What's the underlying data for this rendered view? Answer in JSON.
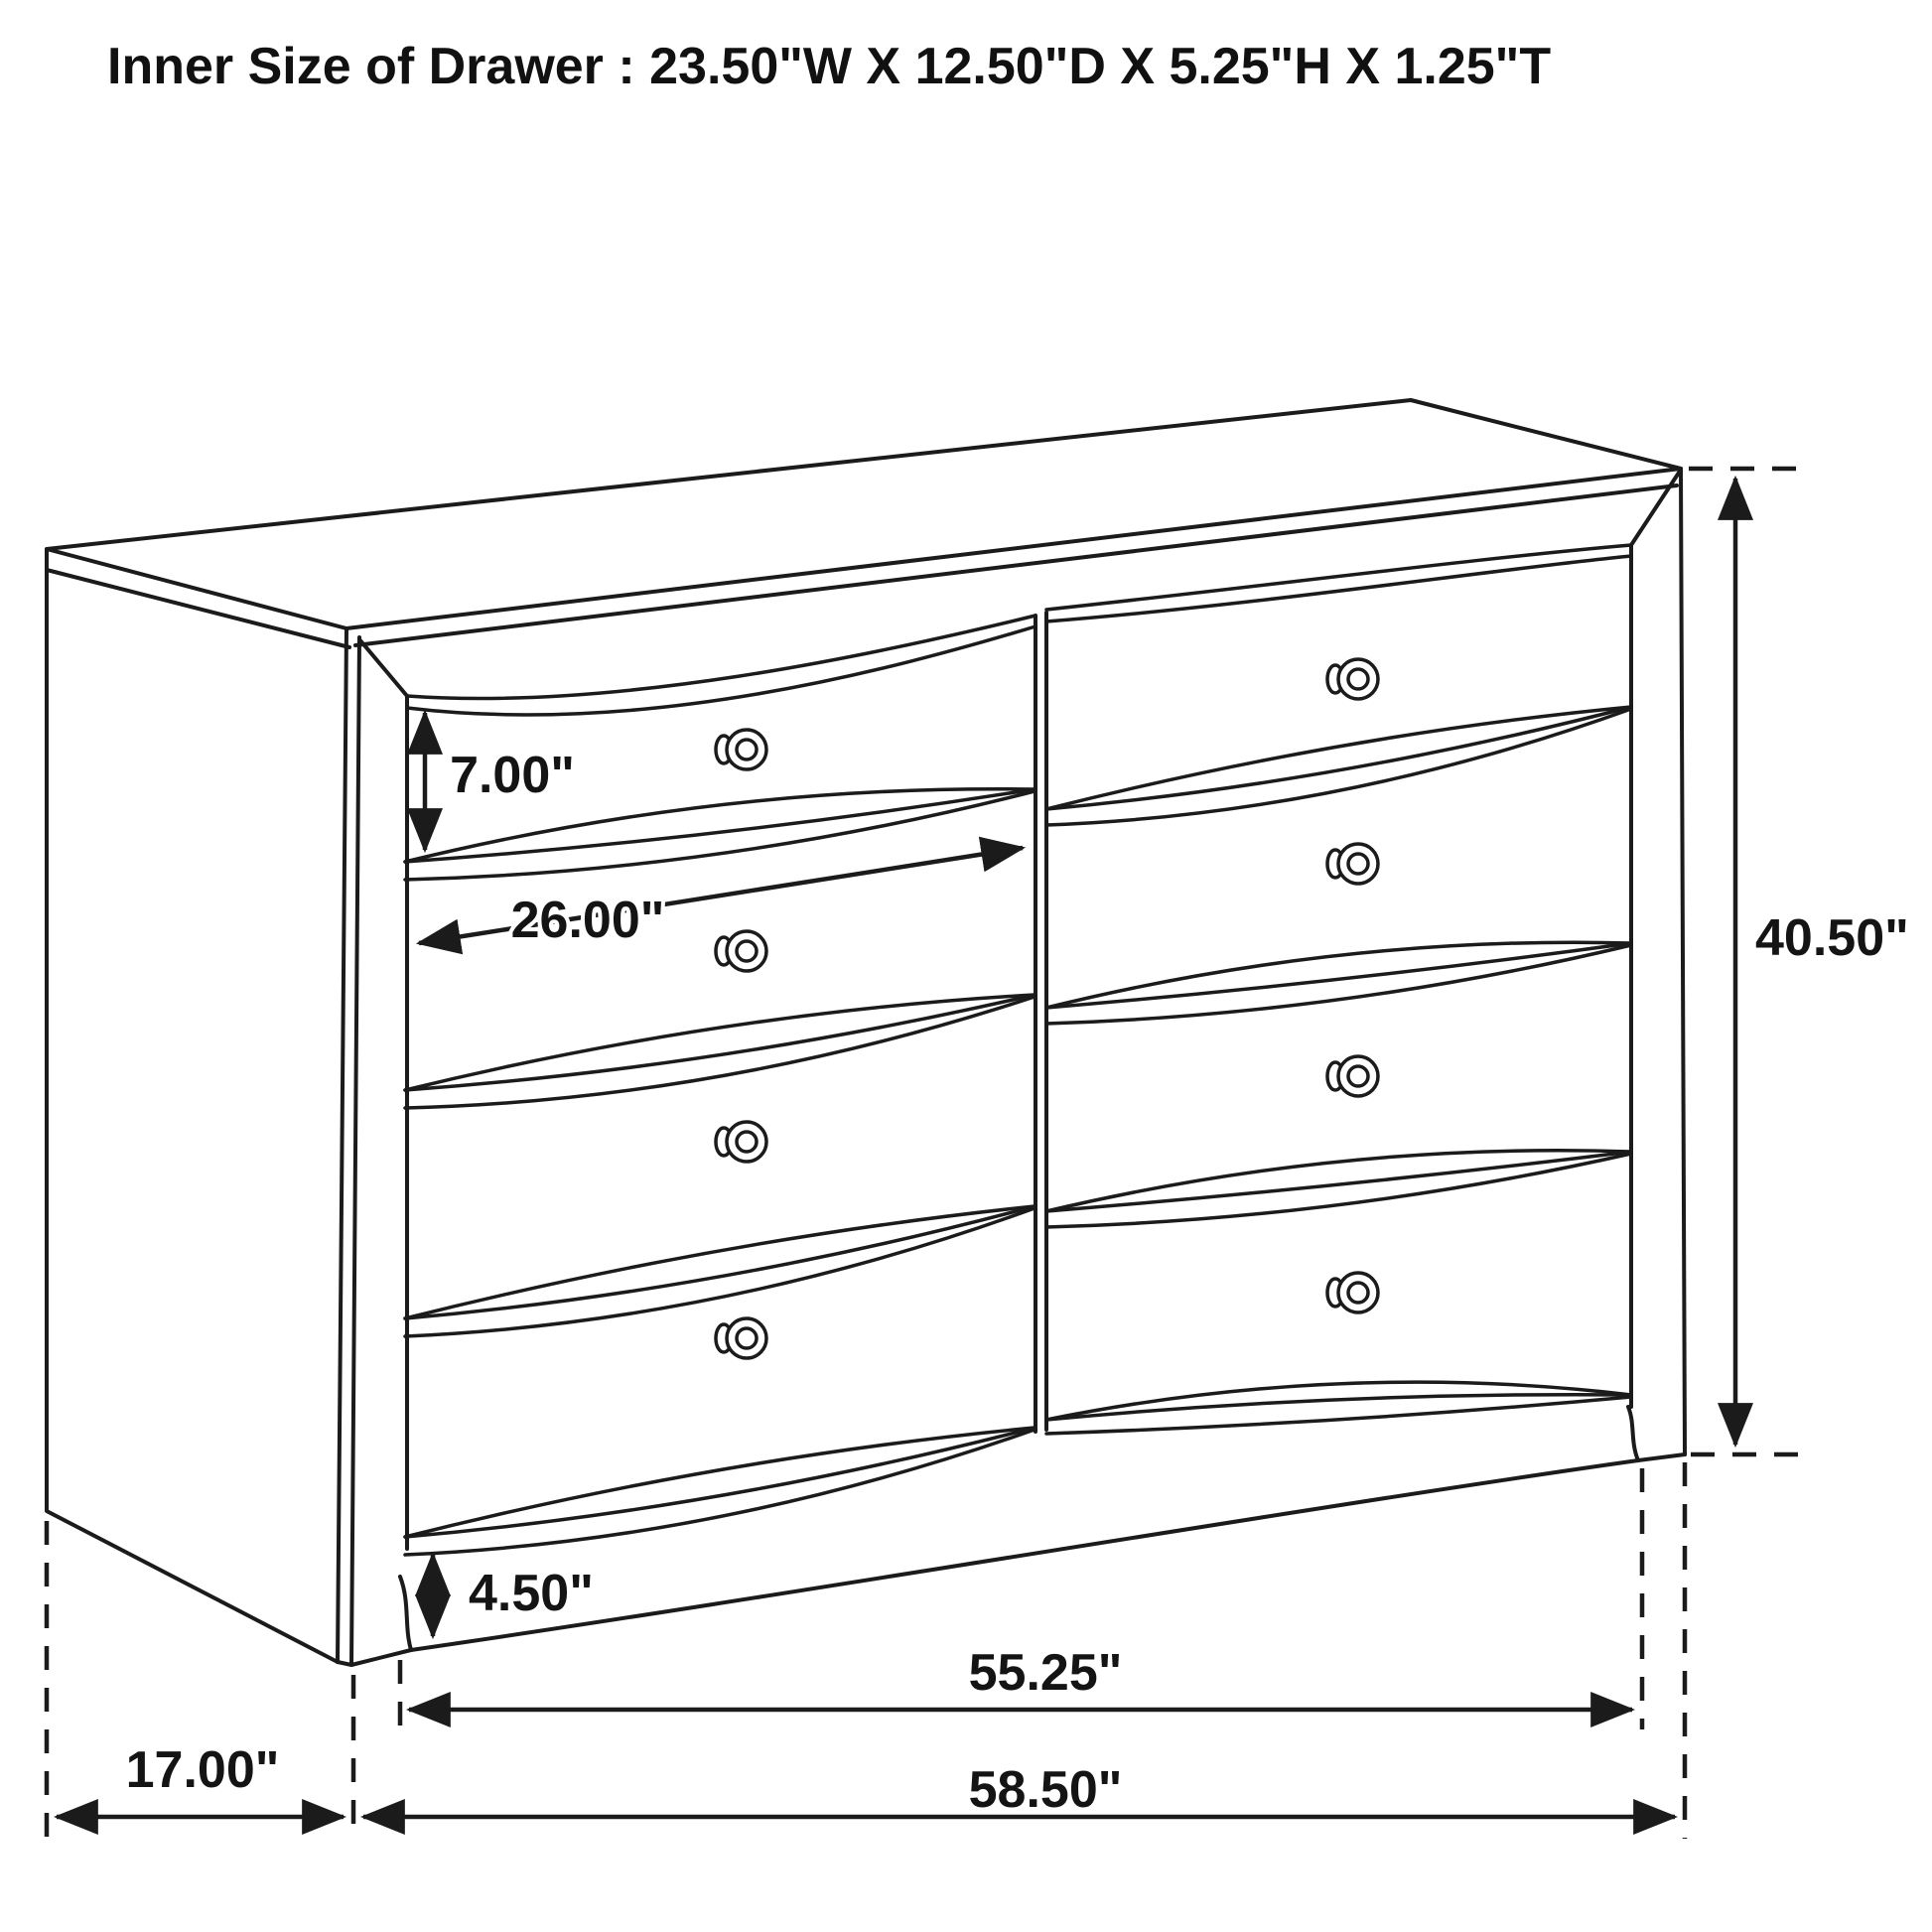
{
  "title": "Inner Size of Drawer : 23.50\"W X 12.50\"D X 5.25\"H X 1.25\"T",
  "dimensions": {
    "drawer_face_height": "7.00\"",
    "drawer_width": "26.00\"",
    "overall_height": "40.50\"",
    "base_height": "4.50\"",
    "front_width": "55.25\"",
    "overall_width": "58.50\"",
    "side_depth": "17.00\""
  },
  "structure": {
    "item": "6-drawer dresser (2 columns x 3 visible rows of sculpted fronts per column, 8 knobs shown)",
    "drawer_columns": 2,
    "knob_count": 8
  },
  "colors": {
    "line": "#1b1b1b",
    "background": "#ffffff"
  }
}
